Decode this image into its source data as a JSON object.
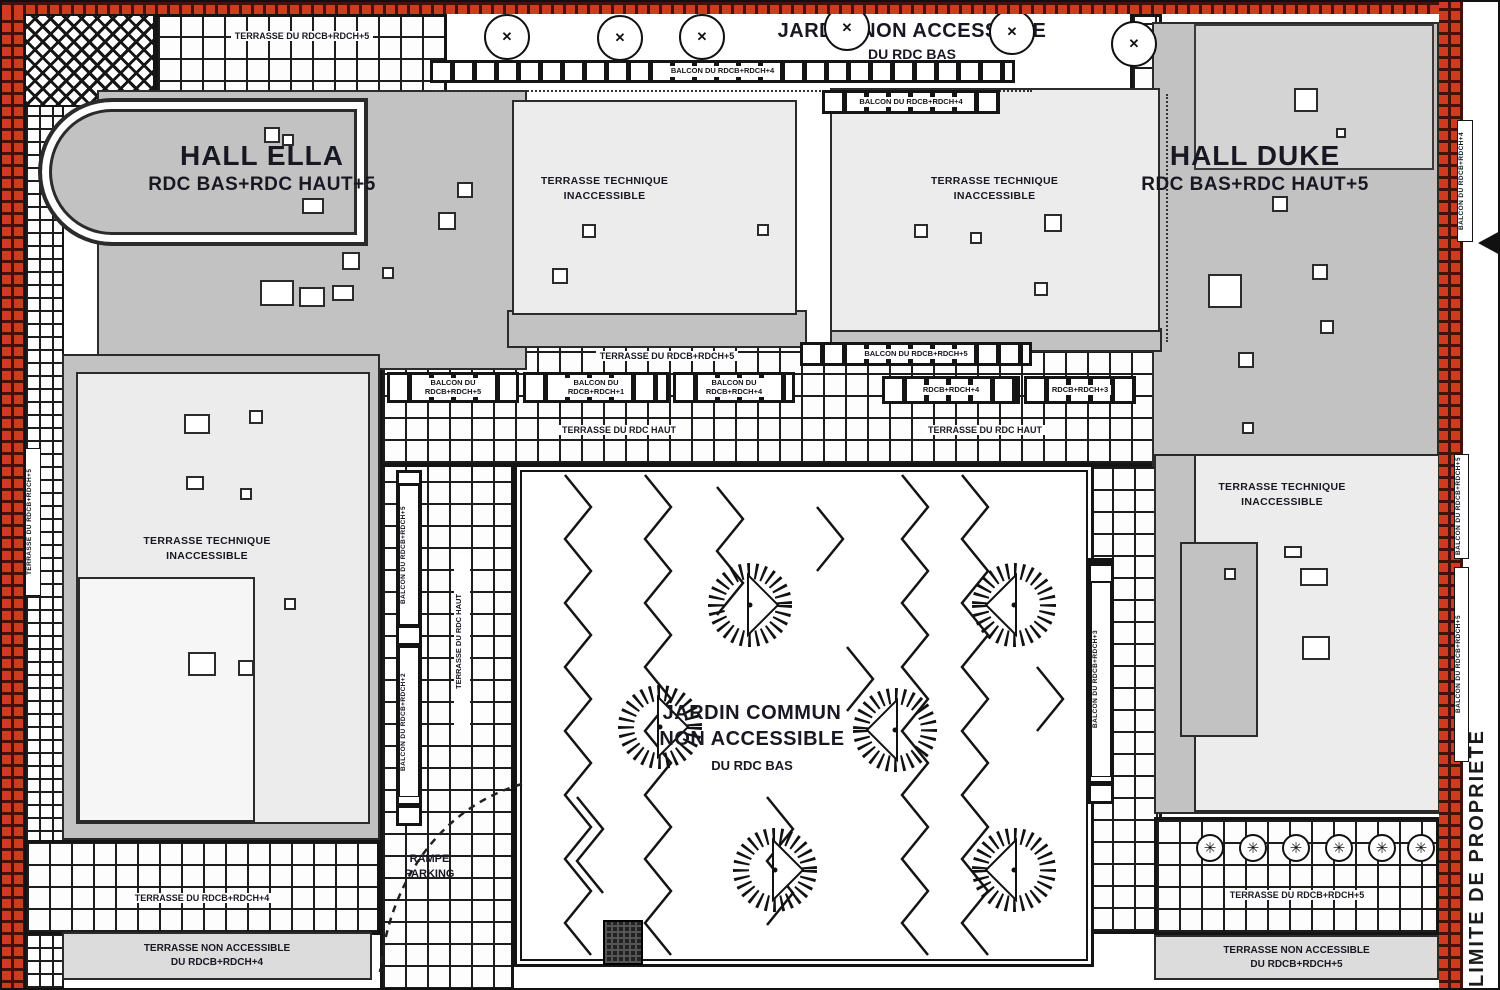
{
  "boundary": {
    "limite": "LIMITE DE PROPRIETE"
  },
  "halls": {
    "ella_name": "HALL ELLA",
    "ella_levels": "RDC BAS+RDC HAUT+5",
    "duke_name": "HALL DUKE",
    "duke_levels": "RDC BAS+RDC HAUT+5"
  },
  "jardin_top": {
    "line1": "JARDIN NON ACCESSIBLE",
    "line2": "DU RDC BAS"
  },
  "jardin_central": {
    "line1": "JARDIN COMMUN",
    "line2": "NON ACCESSIBLE",
    "line3": "DU RDC BAS"
  },
  "technique": {
    "line1": "TERRASSE TECHNIQUE",
    "line2": "INACCESSIBLE"
  },
  "terraces": {
    "top_left": "TERRASSE DU RDCB+RDCH+5",
    "mid": "TERRASSE DU RDCB+RDCH+5",
    "rdc_haut": "TERRASSE DU RDC HAUT",
    "col_vertical": "TERRASSE DU RDC HAUT",
    "left_edge_vertical": "TERRASSE DU RDCB+RDCH+5",
    "bottom_left": "TERRASSE DU RDCB+RDCH+4",
    "bottom_right": "TERRASSE DU RDCB+RDCH+5",
    "na_left_1": "TERRASSE NON ACCESSIBLE",
    "na_left_2": "DU RDCB+RDCH+4",
    "na_right_1": "TERRASSE NON ACCESSIBLE",
    "na_right_2": "DU RDCB+RDCH+5"
  },
  "balconies": {
    "top": "BALCON DU RDCB+RDCH+4",
    "panel2_top": "BALCON DU RDCB+RDCH+4",
    "s0": "BALCON DU RDCB+RDCH+5",
    "s1a": "BALCON DU",
    "s1b": "RDCB+RDCH+5",
    "s2a": "BALCON DU",
    "s2b": "RDCB+RDCH+1",
    "s3a": "BALCON DU",
    "s3b": "RDCB+RDCH+4",
    "r1": "RDCB+RDCH+4",
    "r2": "RDCB+RDCH+3",
    "v_left_1": "BALCON DU RDCB+RDCH+5",
    "v_left_2": "BALCON DU RDCB+RDCH+2",
    "v_right": "BALCON DU RDCB+RDCH+3",
    "margin_1": "BALCON DU RDCB+RDCH+4",
    "margin_2": "BALCON DU RDCB+RDCH+5",
    "margin_3": "BALCON DU RDCB+RDCH+5"
  },
  "parking": {
    "line1": "RAMPE",
    "line2": "PARKING"
  },
  "colors": {
    "boundary_red": "#d03a1e",
    "roof_gray": "#c2c2c2",
    "panel_light": "#ececec",
    "ink": "#181823"
  }
}
